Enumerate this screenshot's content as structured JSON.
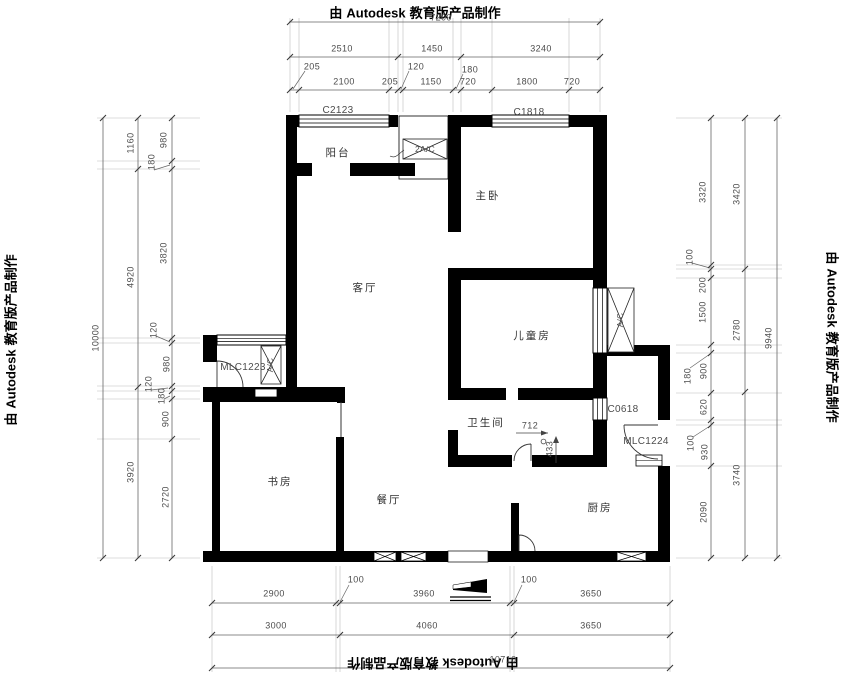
{
  "branding": {
    "prefix": "由",
    "name": "Autodesk",
    "suffix": "教育版产品制作"
  },
  "rooms": {
    "balcony": "阳台",
    "master_bedroom": "主卧",
    "living_room": "客厅",
    "children_room": "儿童房",
    "bathroom": "卫生间",
    "study": "书房",
    "dining_room": "餐厅",
    "kitchen": "厨房"
  },
  "openings": {
    "window_c2123": "C2123",
    "window_c1818": "C1818",
    "door_mlc1223": "MLC1223",
    "window_c0618": "C0618",
    "door_mlc1224": "MLC1224",
    "ac_platform": "2A/C",
    "ac_unit_left": "A/C",
    "ac_unit_right": "A/C"
  },
  "dimensions": {
    "top": {
      "total": "7200",
      "row2": [
        "2510",
        "1450",
        "3240"
      ],
      "row3": [
        "205",
        "2100",
        "205",
        "120",
        "1150",
        "180",
        "720",
        "1800",
        "720"
      ]
    },
    "left": {
      "total": "10000",
      "mid": [
        "1160",
        "4920",
        "3920"
      ],
      "inner": [
        "980",
        "180",
        "3820",
        "120",
        "980",
        "120",
        "180",
        "900",
        "2720"
      ]
    },
    "right": {
      "total": "9940",
      "mid": [
        "3420",
        "2780",
        "3740"
      ],
      "inner": [
        "3320",
        "100",
        "200",
        "1500",
        "180",
        "900",
        "620",
        "100",
        "930",
        "2090"
      ]
    },
    "bottom": {
      "total": "10710",
      "row1": [
        "2900",
        "100",
        "3960",
        "100",
        "3650"
      ],
      "row2": [
        "3000",
        "4060",
        "3650"
      ]
    },
    "interior": {
      "drain_x": "712",
      "drain_y": "433"
    }
  }
}
